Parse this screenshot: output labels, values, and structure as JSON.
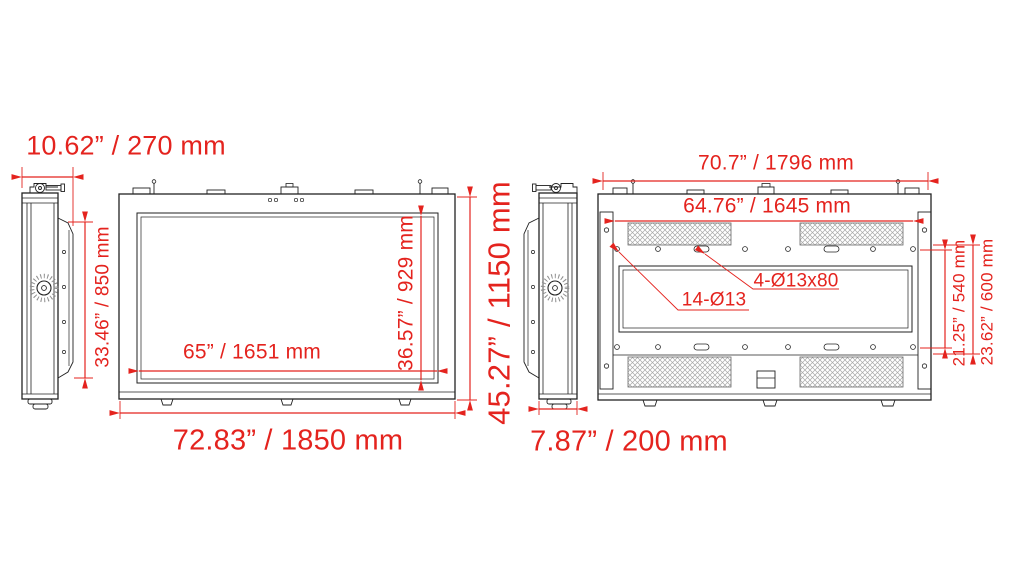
{
  "colors": {
    "dimension_red": "#e4231e",
    "line_black": "#222222",
    "background": "#ffffff"
  },
  "side_view_left": {
    "overall_depth": "10.62” / 270 mm",
    "bracket_height": "33.46” / 850 mm"
  },
  "front_view": {
    "screen_width": "65” / 1651 mm",
    "screen_height": "36.57” / 929 mm",
    "overall_height": "45.27” / 1150 mm",
    "overall_width": "72.83” / 1850 mm"
  },
  "side_view_right": {
    "body_depth": "7.87” / 200 mm"
  },
  "back_view": {
    "overall_width": "70.7” / 1796 mm",
    "mount_width": "64.76” / 1645 mm",
    "slot_callout": "4-Ø13x80",
    "hole_callout": "14-Ø13",
    "mount_height_inner": "21.25” / 540 mm",
    "mount_height_outer": "23.62” / 600 mm"
  }
}
